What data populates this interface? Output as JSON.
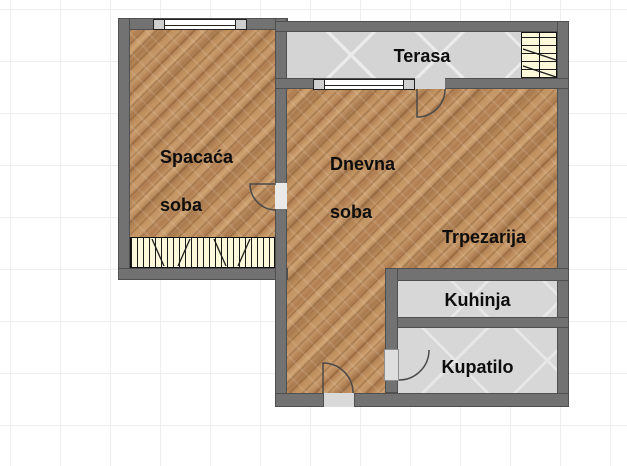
{
  "plan": {
    "type": "apartment-floor-plan",
    "rooms": {
      "bedroom": {
        "line1": "Spacaća",
        "line2": "soba"
      },
      "living": {
        "line1": "Dnevna",
        "line2": "soba"
      },
      "terrace": {
        "label": "Terasa"
      },
      "dining": {
        "label": "Trpezarija"
      },
      "kitchen": {
        "label": "Kuhinja"
      },
      "bathroom": {
        "label": "Kupatilo"
      }
    },
    "symbols": [
      "window-bedroom",
      "window-living",
      "wardrobe-bedroom",
      "shelf-terrace",
      "door-bedroom",
      "door-terrace",
      "door-bathroom",
      "door-entry"
    ],
    "colors": {
      "wall": "#727272",
      "wall_outline": "#4f4f4f",
      "wood_light": "#d0a473",
      "wood_dark": "#a97a4e",
      "terrace_floor": "#d4d4d4",
      "tile_floor": "#d7d7d7",
      "wardrobe_fill": "#fcf8da",
      "door_arc": "#4a4a4a",
      "grid_line": "#eeeeee",
      "label_text": "#0d0d0d"
    }
  }
}
